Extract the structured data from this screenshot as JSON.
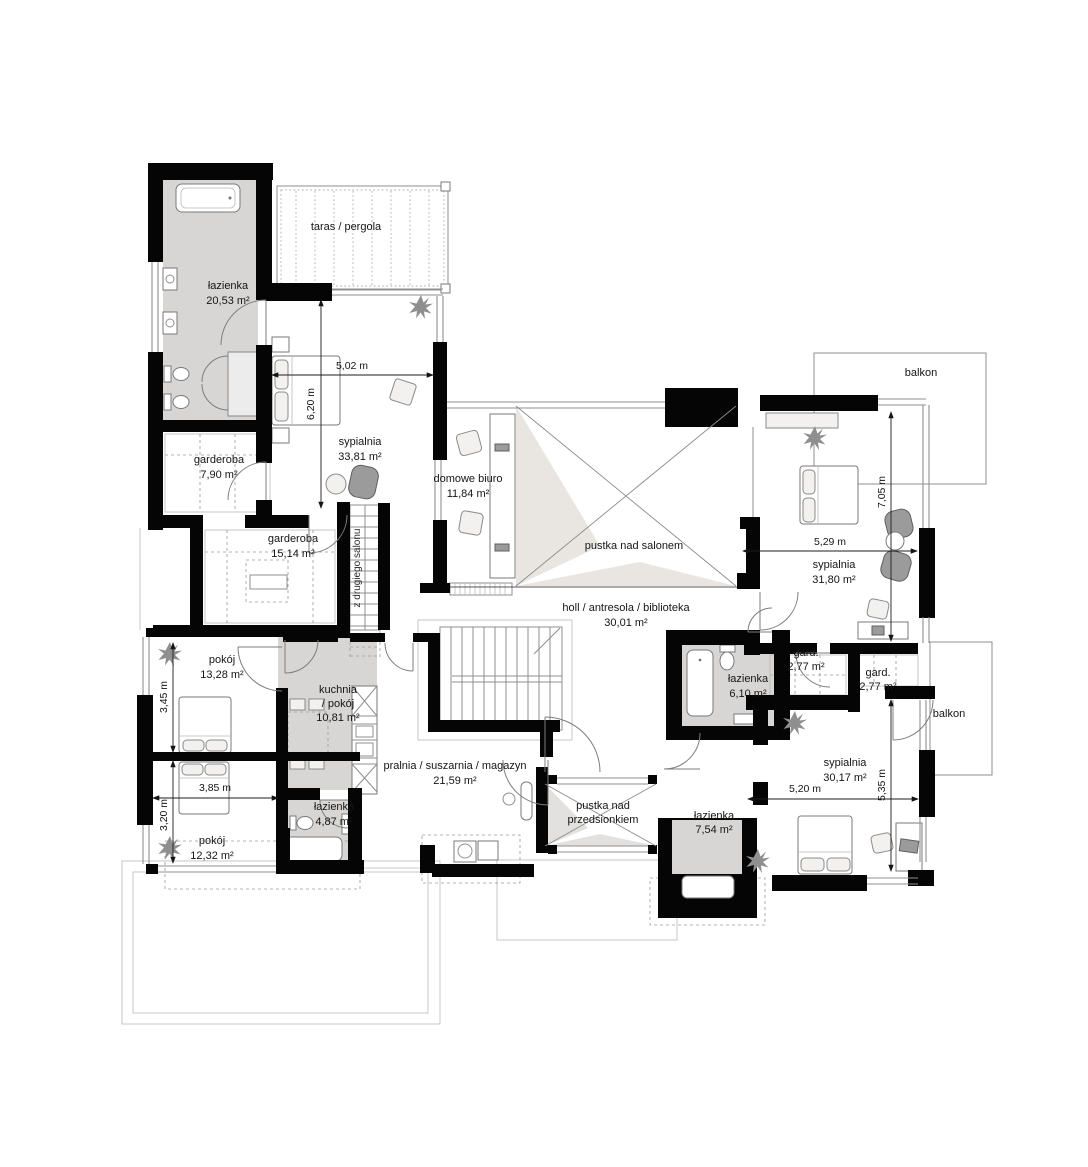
{
  "rooms": [
    {
      "name": "łazienka",
      "area": "20,53 m²"
    },
    {
      "name": "taras / pergola",
      "area": ""
    },
    {
      "name": "sypialnia",
      "area": "33,81 m²"
    },
    {
      "name": "garderoba",
      "area": "7,90 m²"
    },
    {
      "name": "garderoba",
      "area": "15,14 m²"
    },
    {
      "name": "domowe biuro",
      "area": "11,84 m²"
    },
    {
      "name": "pustka nad salonem",
      "area": ""
    },
    {
      "name": "balkon",
      "area": ""
    },
    {
      "name": "sypialnia",
      "area": "31,80 m²"
    },
    {
      "name": "holl / antresola / biblioteka",
      "area": "30,01 m²"
    },
    {
      "name": "pokój",
      "area": "13,28 m²"
    },
    {
      "line1": "kuchnia",
      "line2": "/ pokój",
      "area": "10,81 m²"
    },
    {
      "name": "gard.",
      "area": "2,77 m²"
    },
    {
      "name": "gard.",
      "area": "2,77 m²"
    },
    {
      "name": "łazienka",
      "area": "6,10 m²"
    },
    {
      "name": "balkon",
      "area": ""
    },
    {
      "name": "sypialnia",
      "area": "30,17 m²"
    },
    {
      "name": "pralnia / suszarnia / magazyn",
      "area": "21,59 m²"
    },
    {
      "name": "pokój",
      "area": "12,32 m²"
    },
    {
      "name": "łazienka",
      "area": "4,87 m²"
    },
    {
      "line1": "pustka nad",
      "line2": "przedsionkiem",
      "area": ""
    },
    {
      "name": "łazienka",
      "area": "7,54 m²"
    }
  ],
  "dimensions": [
    "5,02 m",
    "6,20 m",
    "5,29 m",
    "7,05 m",
    "3,45 m",
    "3,85 m",
    "3,20 m",
    "5,20 m",
    "5,35 m"
  ],
  "annotations": {
    "stairs_note": "z drugiego salonu"
  }
}
